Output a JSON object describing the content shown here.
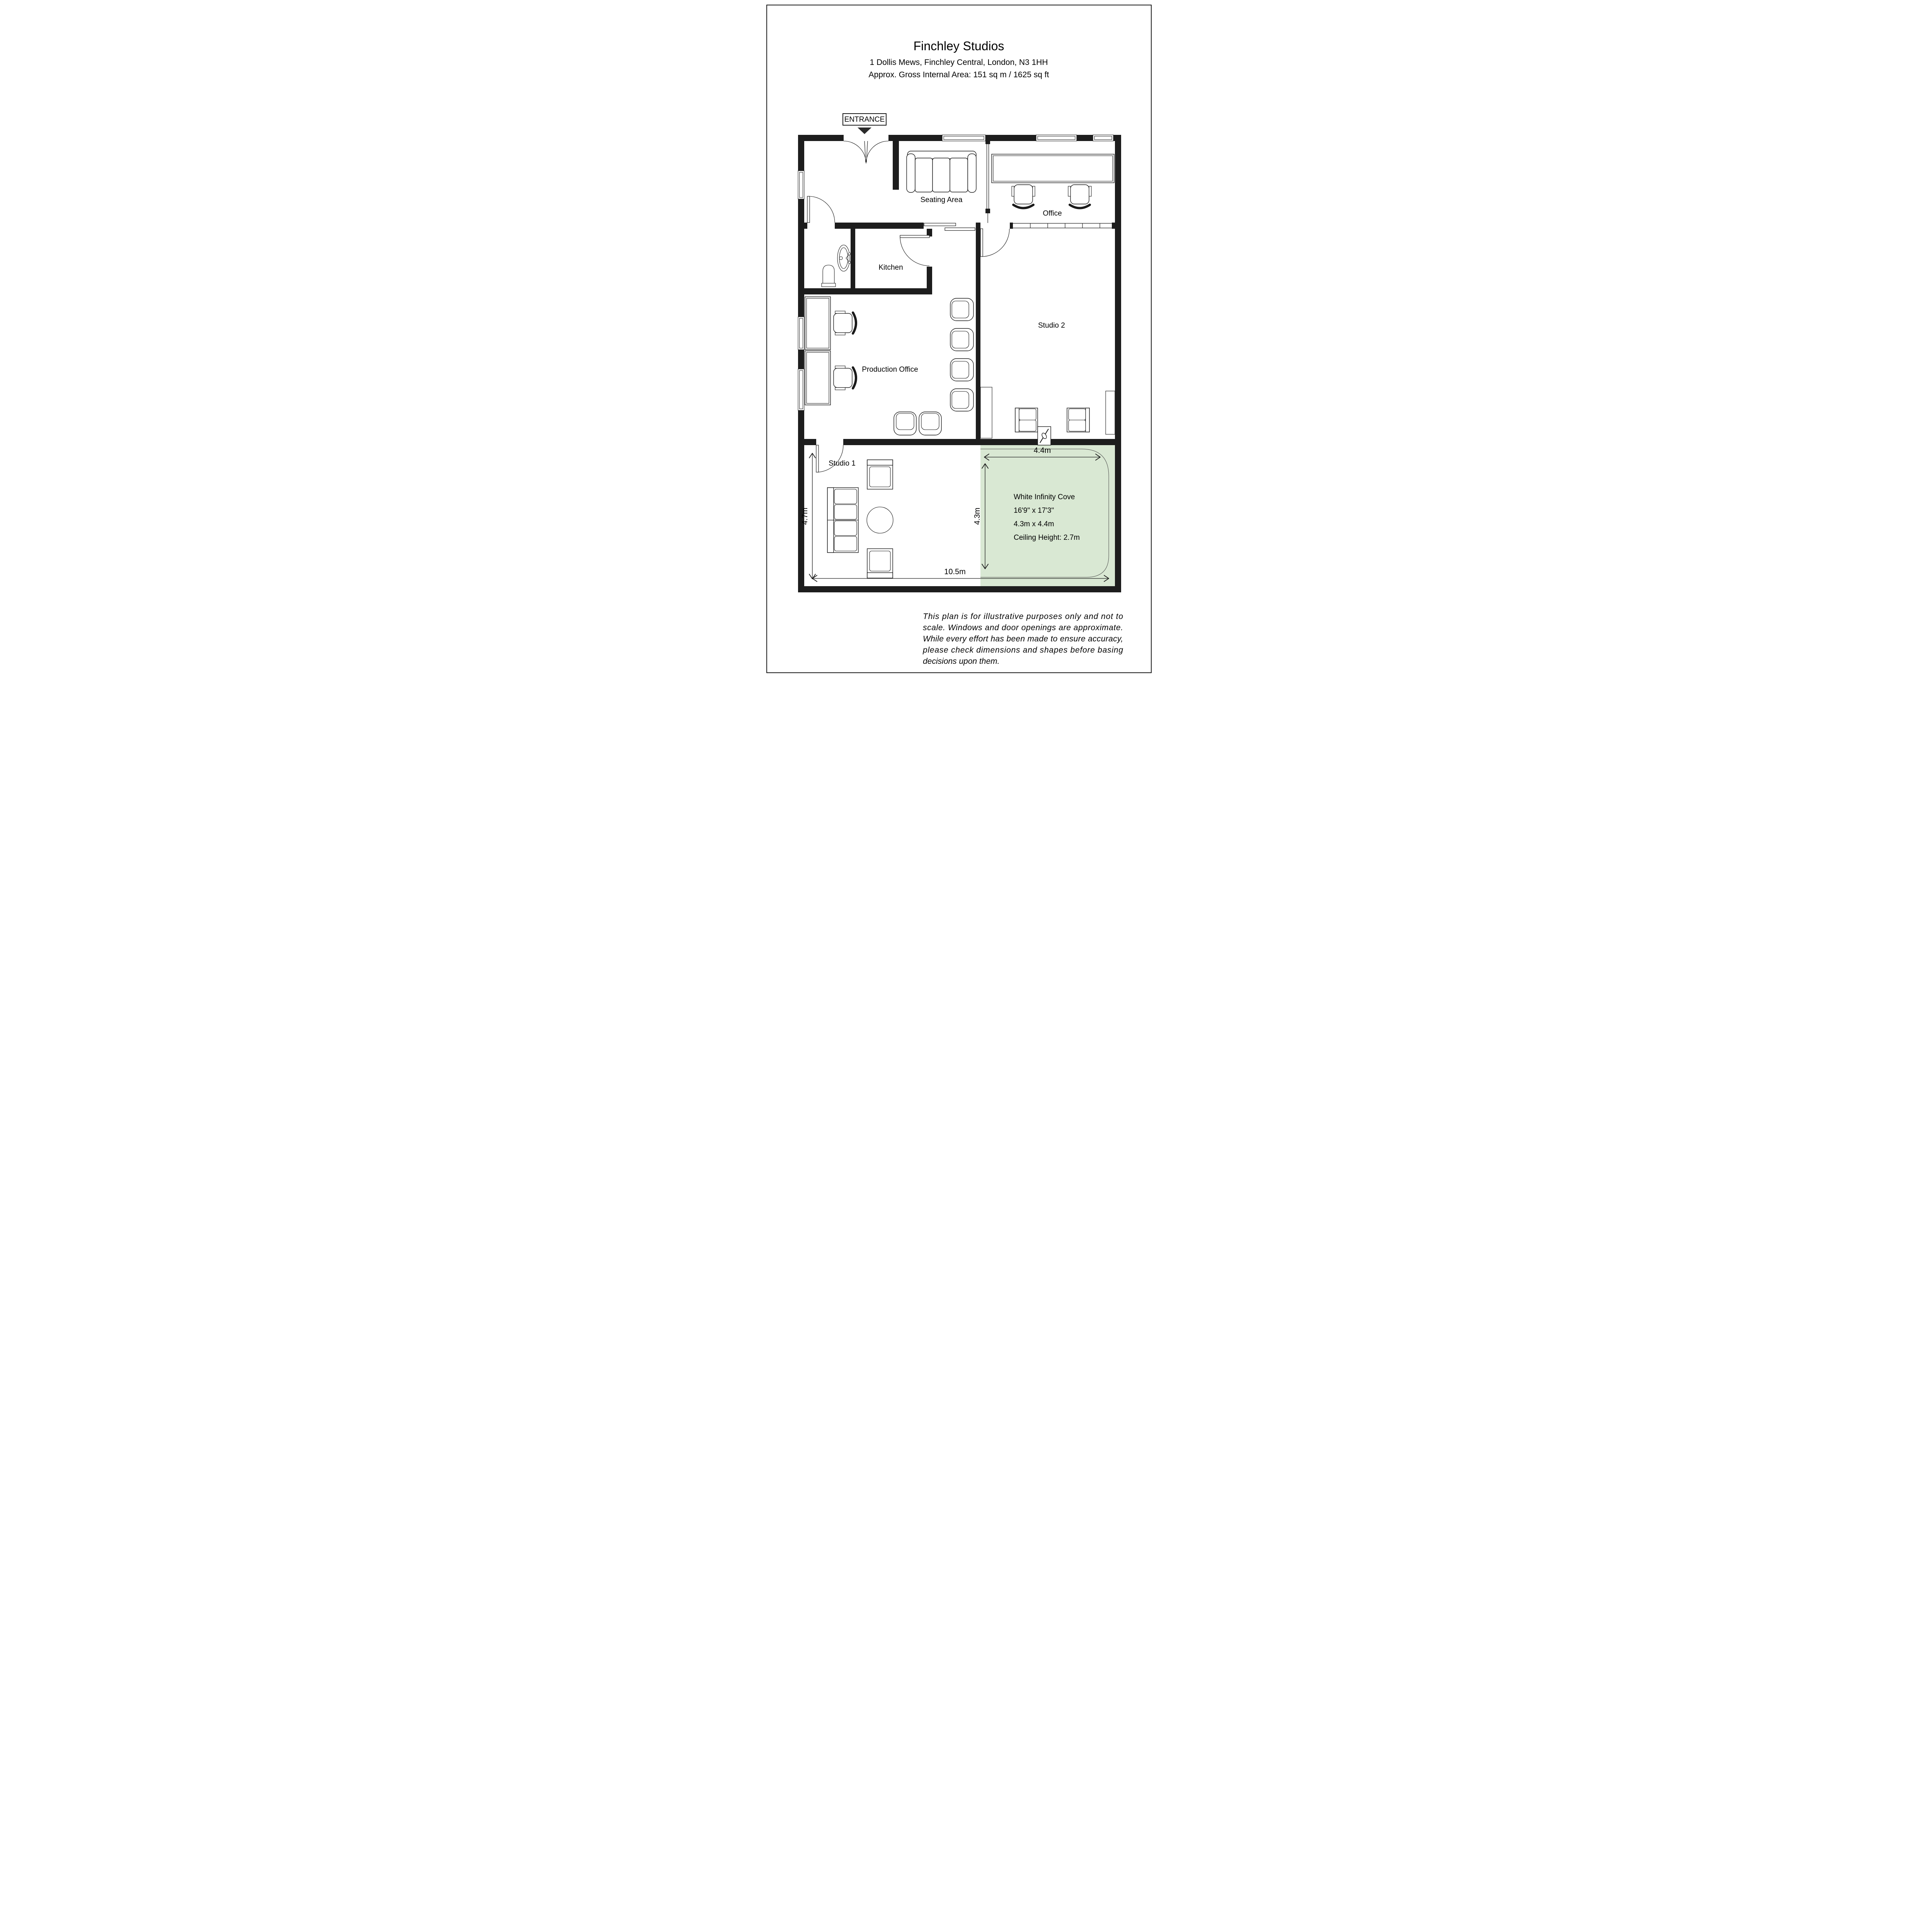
{
  "header": {
    "title": "Finchley Studios",
    "address": "1 Dollis Mews, Finchley Central, London, N3 1HH",
    "area_line": "Approx. Gross Internal Area: 151 sq m / 1625 sq ft"
  },
  "entrance": {
    "label": "ENTRANCE"
  },
  "rooms": {
    "seating_area": "Seating Area",
    "office": "Office",
    "kitchen": "Kitchen",
    "production_office": "Production Office",
    "studio_2": "Studio 2",
    "studio_1": "Studio 1"
  },
  "cove": {
    "name": "White Infinity Cove",
    "size_imperial": "16'9\" x 17'3\"",
    "size_metric": "4.3m x 4.4m",
    "ceiling": "Ceiling Height: 2.7m"
  },
  "dimensions": {
    "cove_width": "4.4m",
    "cove_depth": "4.3m",
    "studio1_depth": "4.7m",
    "total_width": "10.5m"
  },
  "disclaimer": {
    "lines": [
      "This plan is for illustrative purposes only and not to",
      "scale. Windows and door openings are approximate.",
      "While every effort has been made to ensure accuracy,",
      "please check dimensions and shapes before basing",
      "decisions upon them."
    ]
  },
  "colors": {
    "wall": "#1d1d1d",
    "cove_green": "#d9e8d3",
    "line": "#1a1a1a"
  }
}
